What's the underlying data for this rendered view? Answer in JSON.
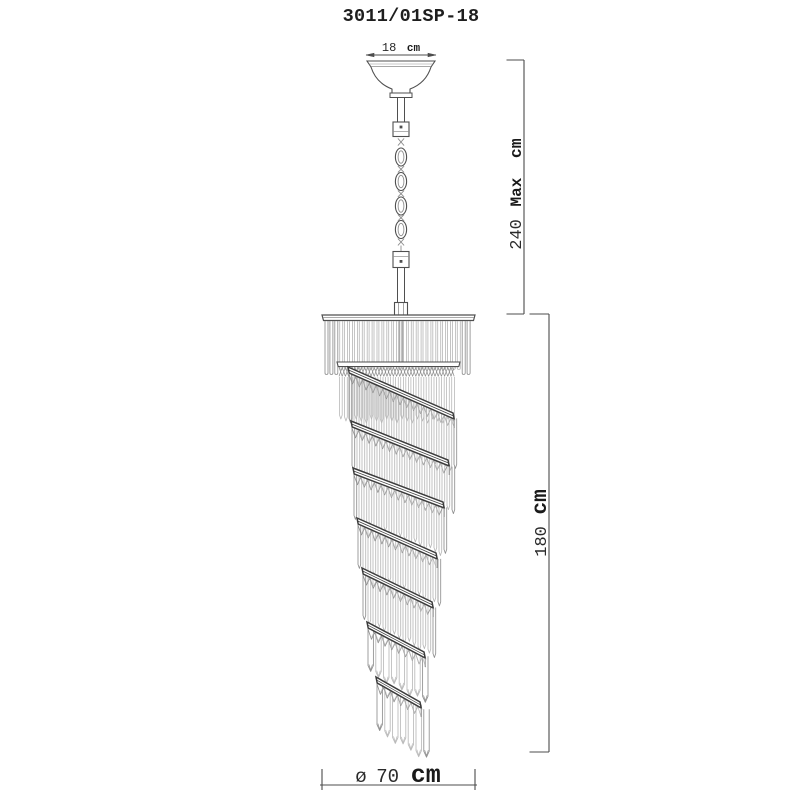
{
  "title": "3011/01SP-18",
  "dimensions": {
    "canopy_width": {
      "value": "18",
      "unit": "cm"
    },
    "hanging_max": {
      "value": "240",
      "label": "Max",
      "unit": "cm"
    },
    "body_height": {
      "value": "180",
      "unit": "cm"
    },
    "diameter": {
      "symbol": "ø",
      "value": "70",
      "unit": "cm"
    }
  },
  "colors": {
    "background": "#ffffff",
    "dim": "#4c4c4c",
    "line": "#4f4f4f",
    "band": "#3c3c3c",
    "mid": "#8f8f8f",
    "light": "#b9b9b9",
    "text": "#1e1e1e"
  }
}
